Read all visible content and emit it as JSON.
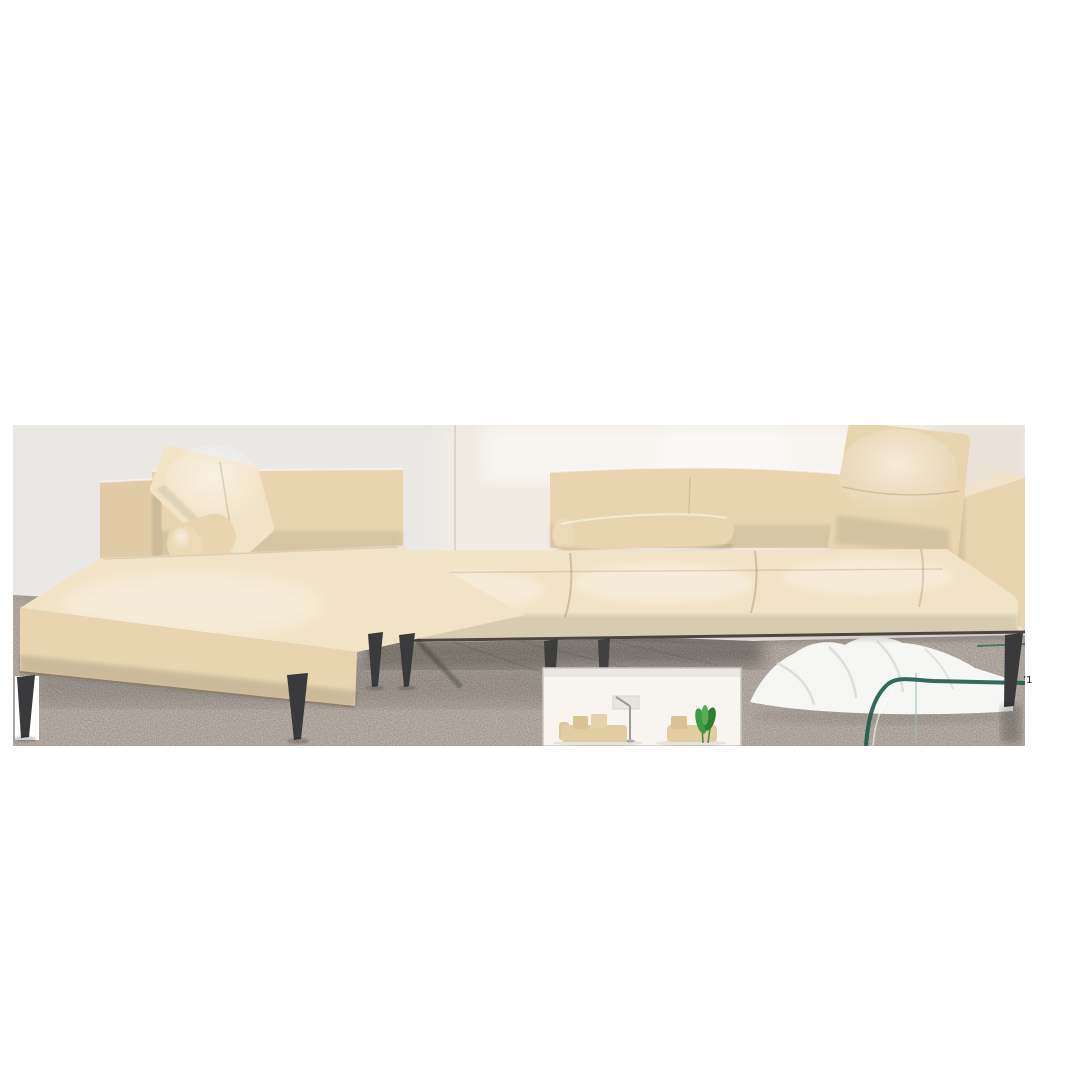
{
  "image": {
    "kind": "product-photo",
    "subject": "Beige leather L-shaped sectional sofa with chaise lounge, slim dark tapered metal legs, loose back pillows and bolster cushions, photographed against a light wall on a speckled granite floor with a curved glass coffee table and a white lounge chair in the background, plus a small inset thumbnail of a styled room scene",
    "artifact_mark": "’1"
  },
  "palette": {
    "page_bg": "#ffffff",
    "wall_left": "#eae8e5",
    "wall_warm": "#f3ece3",
    "wall_corner": "#e2d8c9",
    "wall_line": "#d5d1cd",
    "floor_base": "#b1a8a0",
    "floor_speck_dark": "#6e665f",
    "floor_speck_light": "#ddd6cf",
    "floor_joint": "#8f8780",
    "leather_light": "#f1e3c5",
    "leather_mid": "#e8d5b0",
    "leather_deep": "#e0cba6",
    "leather_cap": "#ecd9b5",
    "leg": "#3a393b",
    "frame_line": "#4b463f",
    "lounge_white": "#f6f6f4",
    "lounge_shade": "#d9d8d3",
    "glass_edge": "#1f5a4c",
    "glass_soft": "#9dbdb4",
    "thumb_bg": "#f8f4ef",
    "thumb_border": "#c9c4bf",
    "thumb_wall_box": "#e8e5e1",
    "thumb_metal": "#9a9a98",
    "thumb_sofa": "#e2cda3",
    "thumb_sofa_arm": "#dcc79c",
    "thumb_cushion": "#d9c293",
    "thumb_cushion_light": "#e6d2a8",
    "thumb_plant": "#3f9b42",
    "thumb_plant_dark": "#2e7d33",
    "thumb_plant_light": "#57ad57",
    "thumb_stem": "#3e8a3e",
    "mark_color": "#1c1c1c"
  },
  "scene": {
    "objects": [
      "sectional-sofa",
      "chaise-section",
      "sofa-back-section",
      "left-arm",
      "right-arm",
      "back-pillow-left",
      "back-pillow-right",
      "bolster-pillow-chaise",
      "bolster-pillow-center",
      "tapered-metal-legs",
      "granite-floor",
      "light-wall",
      "white-lounge-chair",
      "glass-coffee-table",
      "inset-room-thumbnail"
    ]
  }
}
